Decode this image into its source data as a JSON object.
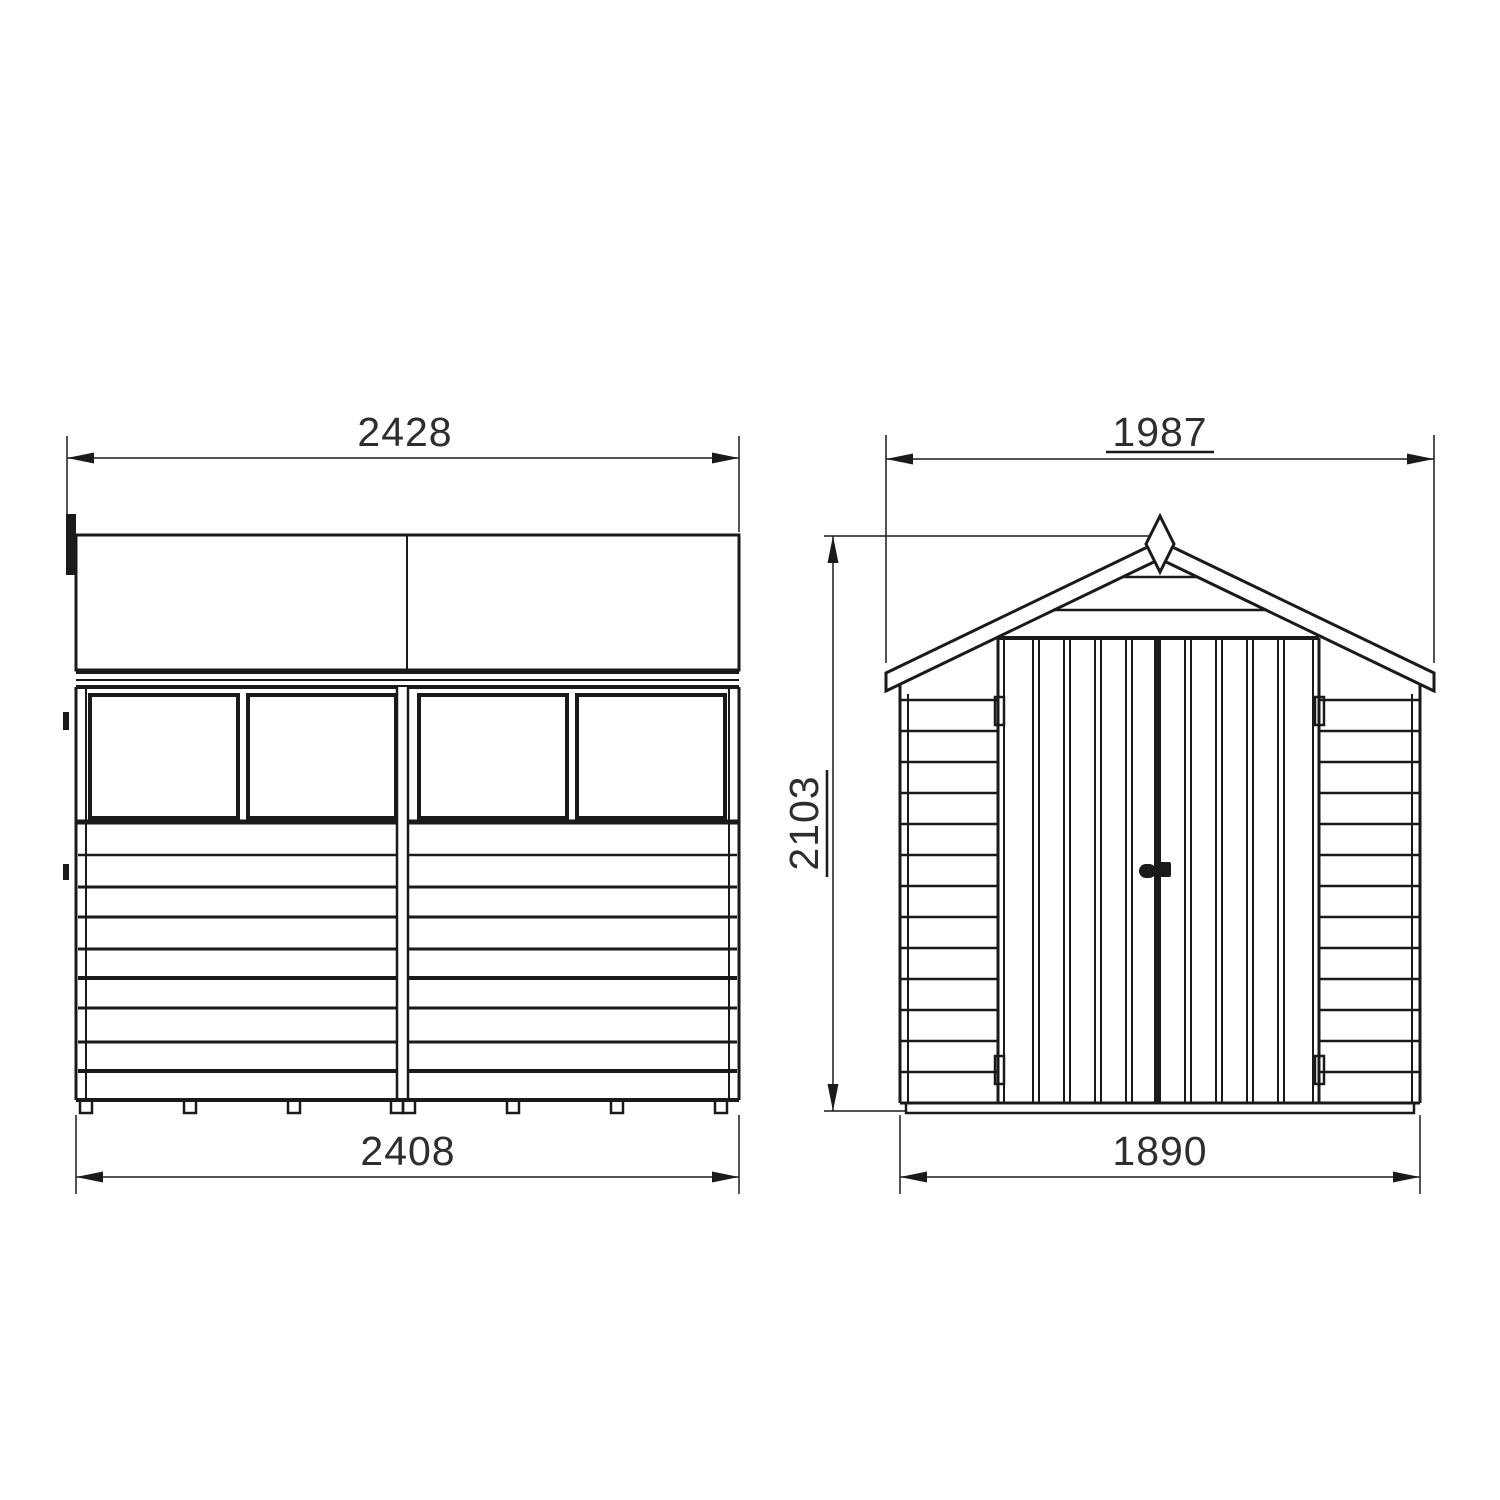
{
  "page": {
    "title": "Garden shed technical line drawing, two orthographic views",
    "background_color": "#ffffff",
    "line_color": "#1a1a1a",
    "text_color": "#2e2e2e"
  },
  "drawing": {
    "views": [
      {
        "id": "side-elevation",
        "name": "Side elevation (left view)",
        "dimensions": [
          {
            "id": "overall-width-top",
            "value": "2428",
            "position": "top",
            "underlined": false
          },
          {
            "id": "base-width-bottom",
            "value": "2408",
            "position": "bottom",
            "underlined": false
          }
        ],
        "features": {
          "windows": 4,
          "window_groups": 2,
          "cladding_board_lines": 8,
          "floor_bearer_tabs": 8,
          "roof_panels": 2
        }
      },
      {
        "id": "front-elevation",
        "name": "Front elevation (right view)",
        "dimensions": [
          {
            "id": "roof-width-top",
            "value": "1987",
            "position": "top",
            "underlined": true
          },
          {
            "id": "ridge-height-left",
            "value": "2103",
            "position": "left",
            "orientation": "vertical",
            "underlined": true
          },
          {
            "id": "base-width-bottom",
            "value": "1890",
            "position": "bottom",
            "underlined": false
          }
        ],
        "features": {
          "doors": 2,
          "hinges": 4,
          "door_handle": true,
          "apex_finial": true,
          "gable_board_lines": 2,
          "side_cladding_lines": 13
        }
      }
    ]
  }
}
